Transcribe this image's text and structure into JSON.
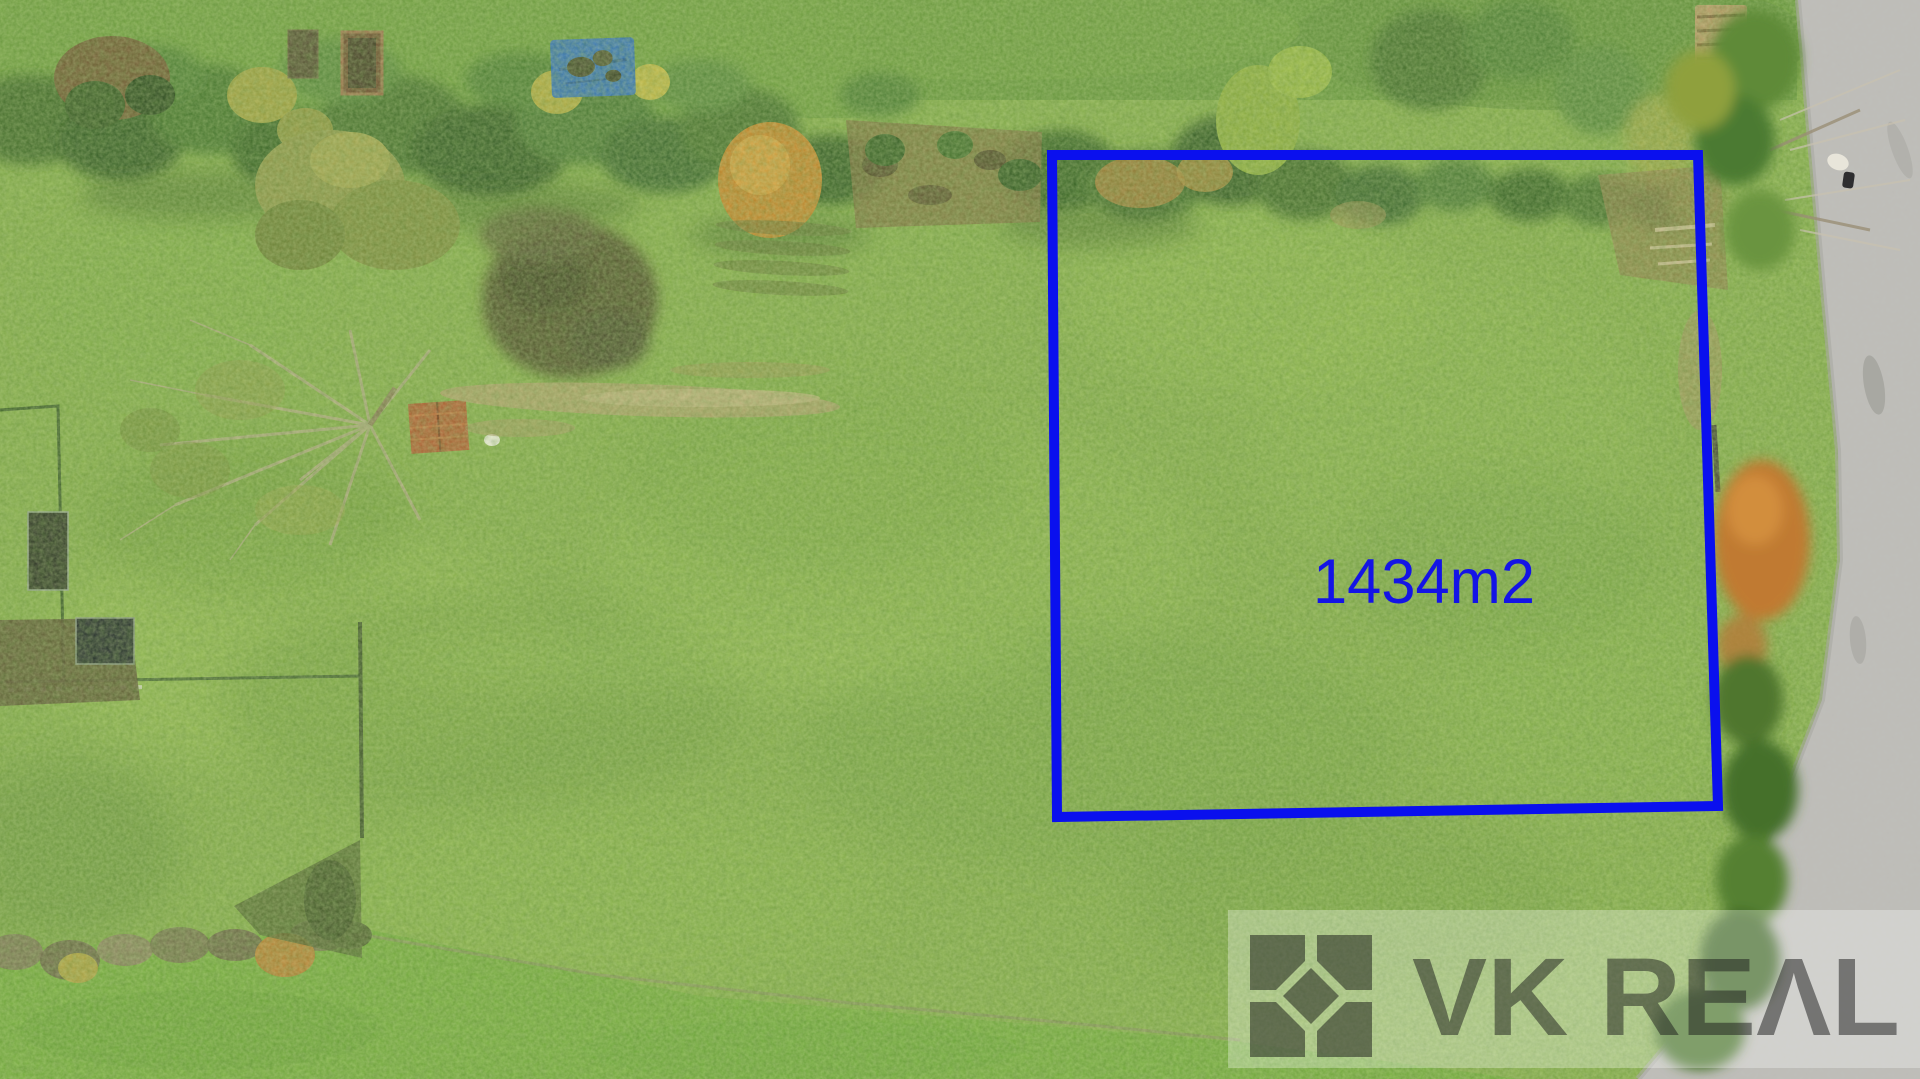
{
  "scene": {
    "type": "aerial-drone-photo",
    "subject": "grassy land plot bordered by autumn tree line, gardens on the left and asphalt road on the right",
    "grass_color": "#85ad4a",
    "road_color": "#bdbcb7",
    "hedge_color": "#3a6427",
    "autumn_accent_color": "#c98328"
  },
  "plot": {
    "area_label": "1434m2",
    "outline_color": "#0a10ee",
    "label_color": "#1414e6"
  },
  "watermark": {
    "brand": "VK REAL",
    "brand_display": "VK REΛL",
    "band_color": "#ffffff",
    "logo_color": "#1a1a1a"
  }
}
